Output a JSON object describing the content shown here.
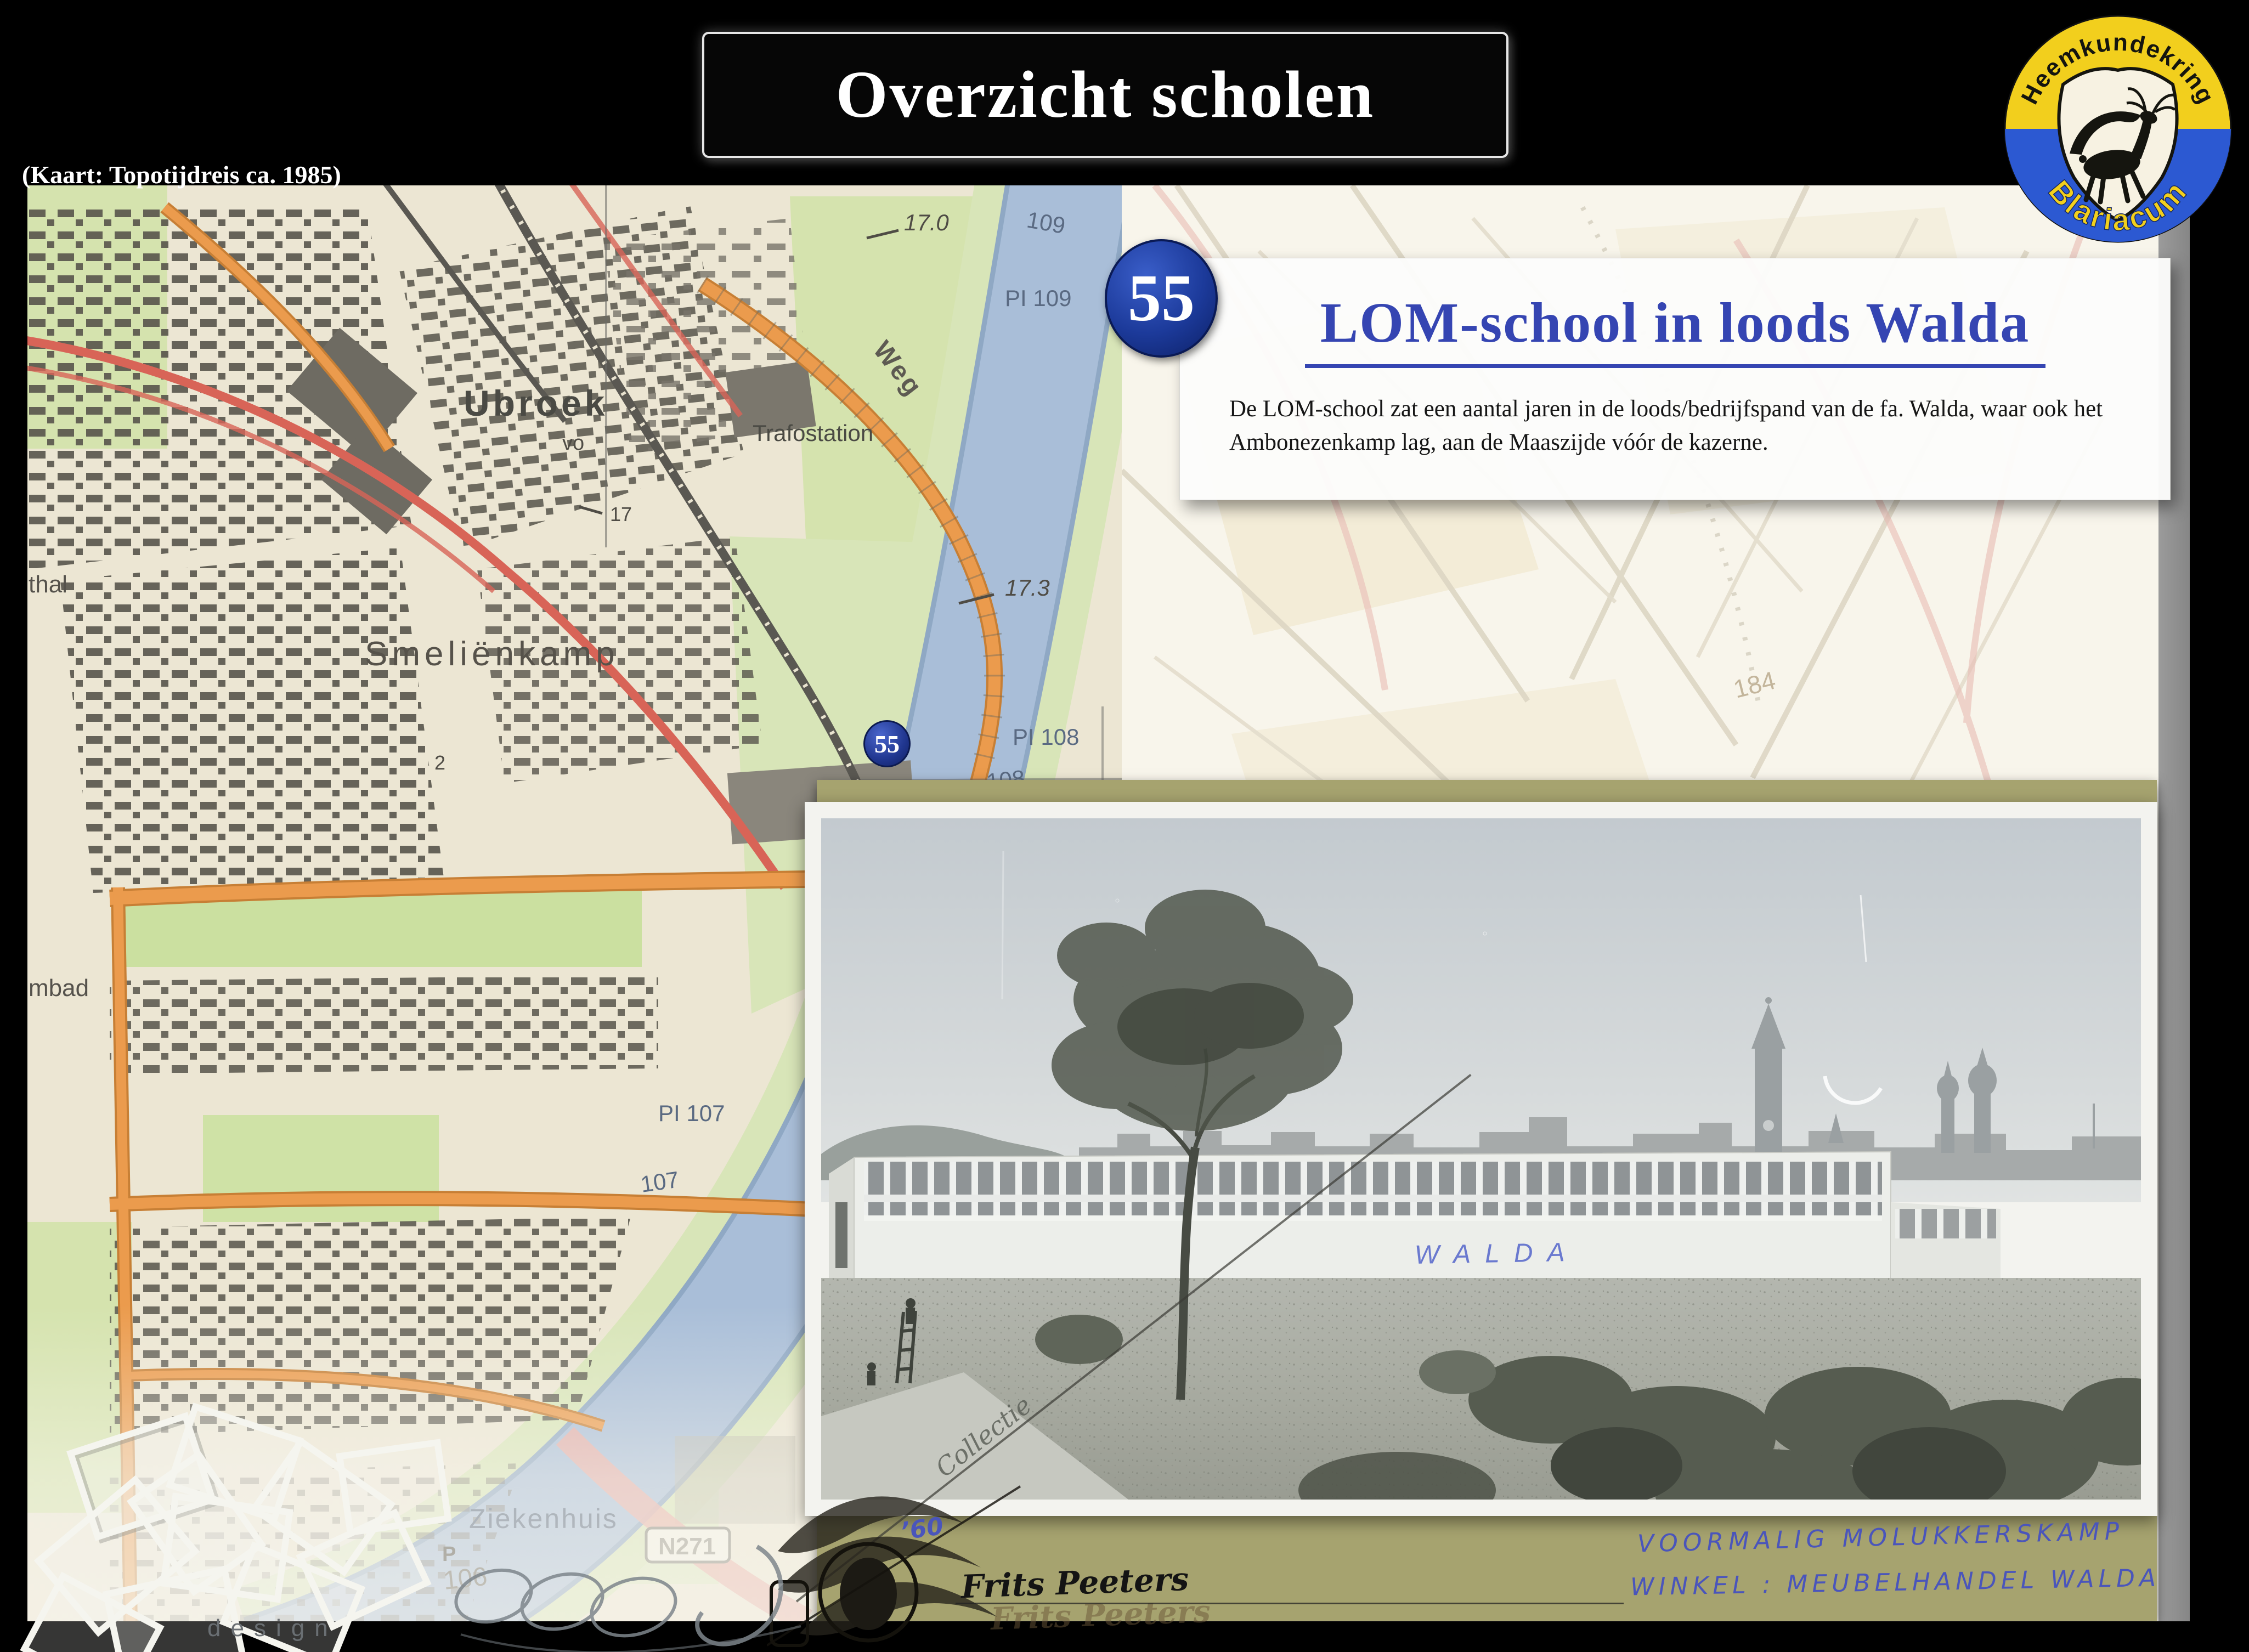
{
  "header": {
    "title": "Overzicht scholen",
    "map_credit": "(Kaart: Topotijdreis ca. 1985)"
  },
  "logo": {
    "arc_top": "Heemkundekring",
    "arc_bottom": "Blariacum"
  },
  "card": {
    "number": "55",
    "title": "LOM-school in loods Walda",
    "body": "De LOM-school zat een aantal jaren in de loods/bedrijfspand van de fa. Walda, waar ook het Ambonezenkamp lag, aan de Maaszijde vóór de kazerne."
  },
  "map": {
    "marker_number": "55",
    "labels": {
      "ubroek": "Ubroek",
      "vo": "vo",
      "spot17": "17",
      "weg": "Weg",
      "trafostation": "Trafostation",
      "spot170": "17.0",
      "river109": "109",
      "pl109": "PI 109",
      "smelienkamp": "Smeliënkamp",
      "spot173": "17.3",
      "pl108": "PI 108",
      "river108": "108",
      "pl107": "PI 107",
      "river107": "107",
      "ziekenhuis": "Ziekenhuis",
      "n271": "N271",
      "river106": "106",
      "parking": "P",
      "zwembad_partial": "mbad",
      "sporthal_partial": "thal",
      "plot2": "2",
      "faded184": "184"
    }
  },
  "photo": {
    "building_graffiti": "WALDA",
    "collection_watermark": "Collectie",
    "year_note": "’60",
    "mount_caption_line1": "VOORMALIG  MOLUKKERSKAMP",
    "mount_caption_line2": "WINKEL : MEUBELHANDEL WALDA",
    "signature": "Frits Peeters",
    "signature_shadow": "Frits Peeters"
  },
  "watermark": {
    "design_label": "design"
  },
  "colors": {
    "accent_blue": "#3545b2",
    "badge_navy": "#17368f",
    "logo_yellow": "#f2cf1d",
    "logo_blue": "#2c59d2",
    "mount_khaki": "#a6a36f"
  }
}
